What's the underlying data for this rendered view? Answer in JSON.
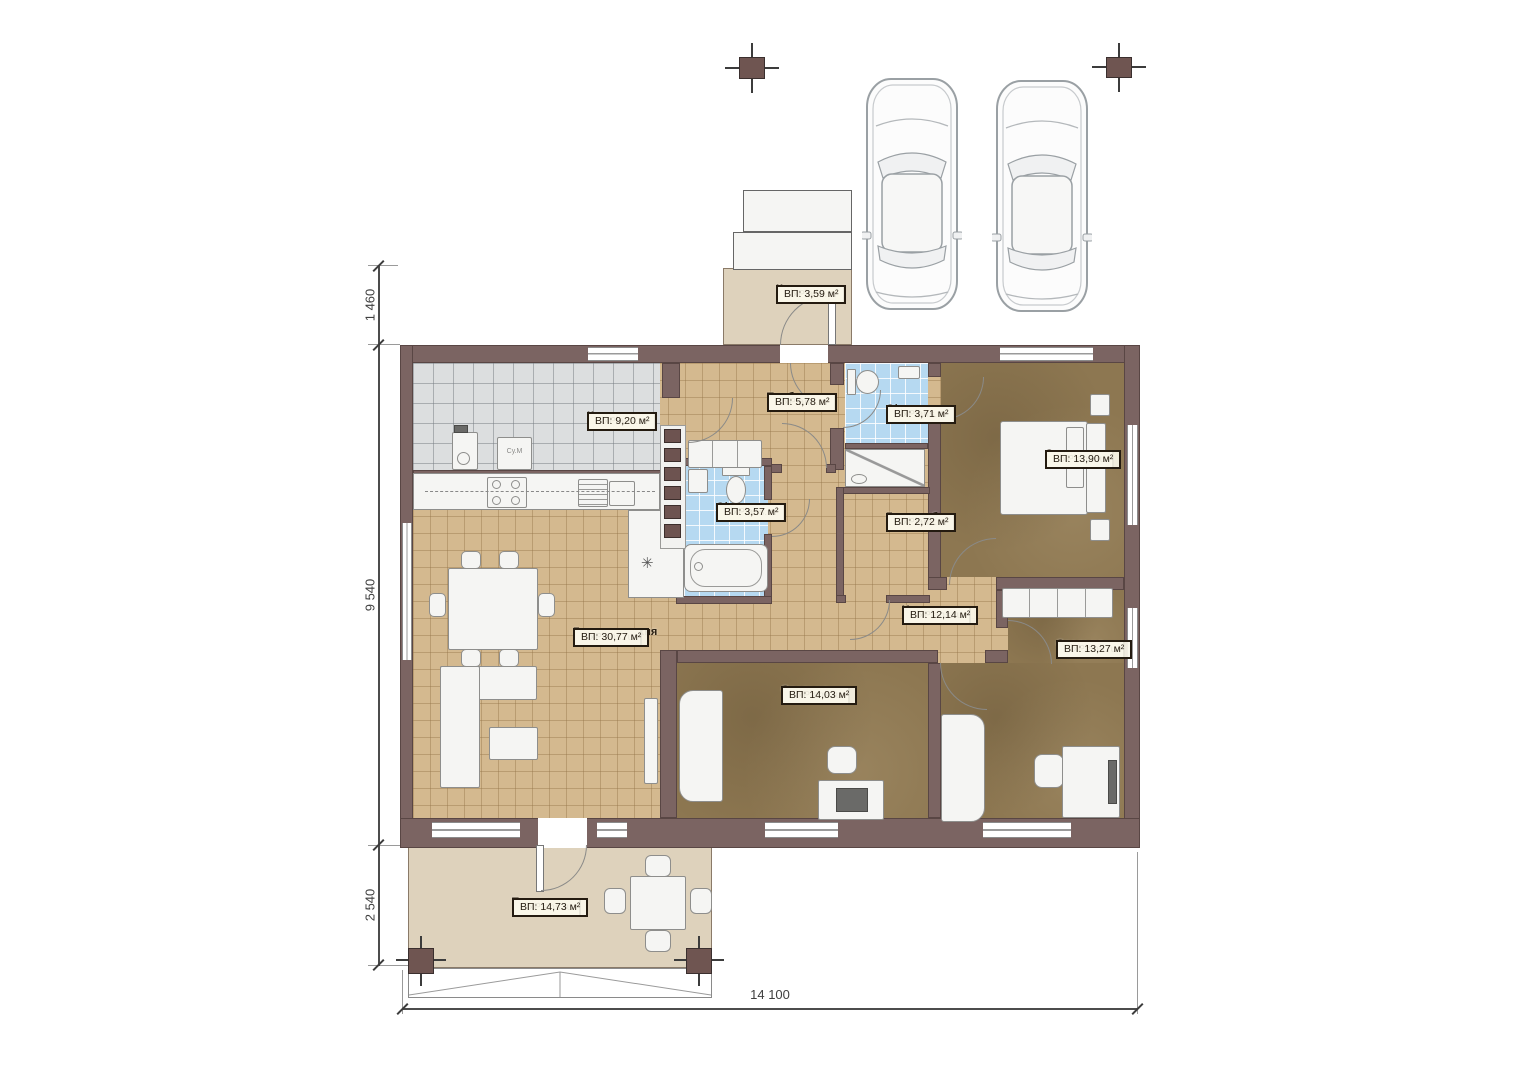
{
  "watermark": "FixPlans.ru",
  "rooms": [
    {
      "key": "porch",
      "name": "Крыльцо",
      "area": "ВП: 3,59 м²"
    },
    {
      "key": "boiler",
      "name": "Котельная",
      "area": "ВП: 9,20 м²"
    },
    {
      "key": "vestibule",
      "name": "Тамбур",
      "area": "ВП: 5,78 м²"
    },
    {
      "key": "bathroom-top",
      "name": "С/у",
      "area": "ВП: 3,71 м²"
    },
    {
      "key": "bedroom-master",
      "name": "Спальня",
      "area": "ВП: 13,90 м²"
    },
    {
      "key": "bathroom-main",
      "name": "С/у",
      "area": "ВП: 3,57 м²"
    },
    {
      "key": "wardrobe",
      "name": "Гардероб",
      "area": "ВП: 2,72 м²"
    },
    {
      "key": "hall",
      "name": "Холл",
      "area": "ВП: 12,14 м²"
    },
    {
      "key": "living-kitchen",
      "name": "Гостиная-кухня",
      "area": "ВП: 30,77 м²"
    },
    {
      "key": "bedroom-middle",
      "name": "Спальня",
      "area": "ВП: 14,03 м²"
    },
    {
      "key": "bedroom-right",
      "name": "Спальня",
      "area": "ВП: 13,27 м²"
    },
    {
      "key": "terrace",
      "name": "Терасса",
      "area": "ВП: 14,73 м²"
    }
  ],
  "dimensions": {
    "left_top": "1 460",
    "left_middle": "9 540",
    "left_bottom": "2 540",
    "bottom_width": "14 100"
  },
  "appliances": {
    "washer_label": "Су.М"
  },
  "symbols": {
    "snowflake": "✳"
  },
  "colors": {
    "wall": "#7b6462",
    "floor_beige": "#d4b98f",
    "floor_gray": "#dcdedf",
    "floor_blue": "#b6d9f1",
    "floor_brown": "#8d7751",
    "terrace": "#ded2bc",
    "label_border": "#241b10"
  }
}
